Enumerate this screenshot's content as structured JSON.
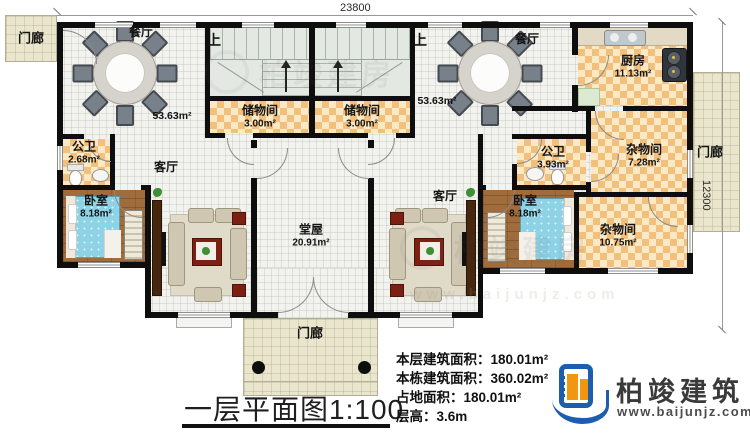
{
  "dims": {
    "width": "23800",
    "height": "12300"
  },
  "rooms": {
    "porch_tl": "门廊",
    "porch_r": "门廊",
    "porch_b": "门廊",
    "stairs_l": "上",
    "stairs_r": "上",
    "dining_l": {
      "name": "餐厅",
      "area": "53.63m²"
    },
    "dining_r": {
      "name": "餐厅",
      "area": "53.63m²"
    },
    "storage_l": {
      "name": "储物间",
      "area": "3.00m²"
    },
    "storage_r": {
      "name": "储物间",
      "area": "3.00m²"
    },
    "kitchen": {
      "name": "厨房",
      "area": "11.13m²"
    },
    "bath_l": {
      "name": "公卫",
      "area": "2.68m²"
    },
    "bath_r": {
      "name": "公卫",
      "area": "3.93m²"
    },
    "living_l": {
      "name": "客厅"
    },
    "living_r": {
      "name": "客厅"
    },
    "bedroom_l": {
      "name": "卧室",
      "area": "8.18m²"
    },
    "bedroom_r": {
      "name": "卧室",
      "area": "8.18m²"
    },
    "utility_s": {
      "name": "杂物间",
      "area": "7.28m²"
    },
    "utility_b": {
      "name": "杂物间",
      "area": "10.75m²"
    },
    "hall": {
      "name": "堂屋",
      "area": "20.91m²"
    }
  },
  "footer": {
    "title": "一层平面图",
    "scale": "1:100",
    "stats": [
      {
        "label": "本层建筑面积：",
        "value": "180.01m²"
      },
      {
        "label": "本栋建筑面积：",
        "value": "360.02m²"
      },
      {
        "label": "占地面积：",
        "value": "180.01m²"
      },
      {
        "label": "层高：",
        "value": "3.6m"
      }
    ]
  },
  "brand": {
    "name": "柏竣建筑",
    "url": "www.baijunjz.com"
  },
  "watermark": {
    "text": "柏竣建房",
    "url": "www.baijunjz.com"
  }
}
